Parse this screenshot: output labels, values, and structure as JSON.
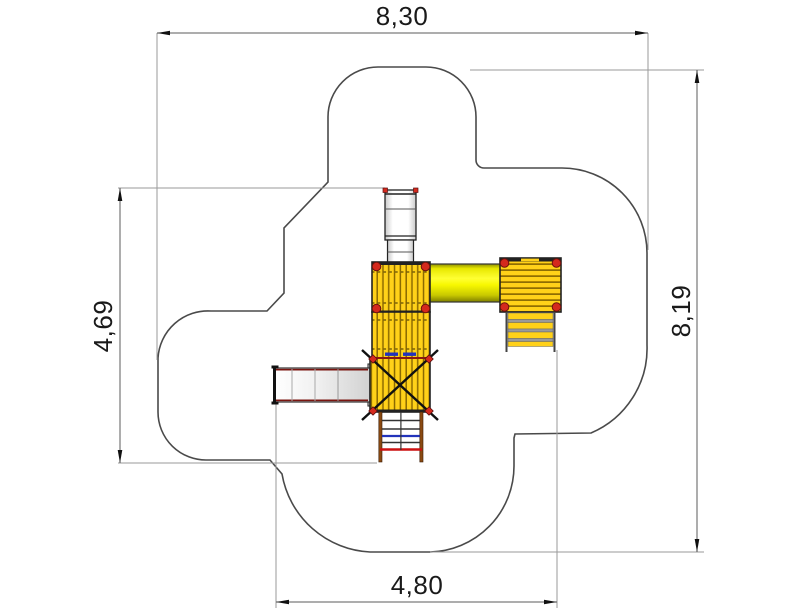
{
  "drawing": {
    "title": "Playground equipment top view with safety zone plan",
    "dimensions": {
      "top_width_m": "8,30",
      "right_height_m": "8,19",
      "left_height_m": "4,69",
      "bottom_width_m": "4,80"
    },
    "colors": {
      "plank_yellow": "#ffd119",
      "plank_gap": "#a87f00",
      "plank_line": "#6b5200",
      "tube_yellow": "#f8f800",
      "post_red": "#d4291d",
      "rung_blue": "#2233bb",
      "rung_red": "#cc1111",
      "ladder_brown": "#8a4a12",
      "slide_gray": "#d2d2d2",
      "slide_edge_red": "#7a1510",
      "outline_gray": "#4a4a4a",
      "dimension_text": "#1a1a1a"
    }
  }
}
